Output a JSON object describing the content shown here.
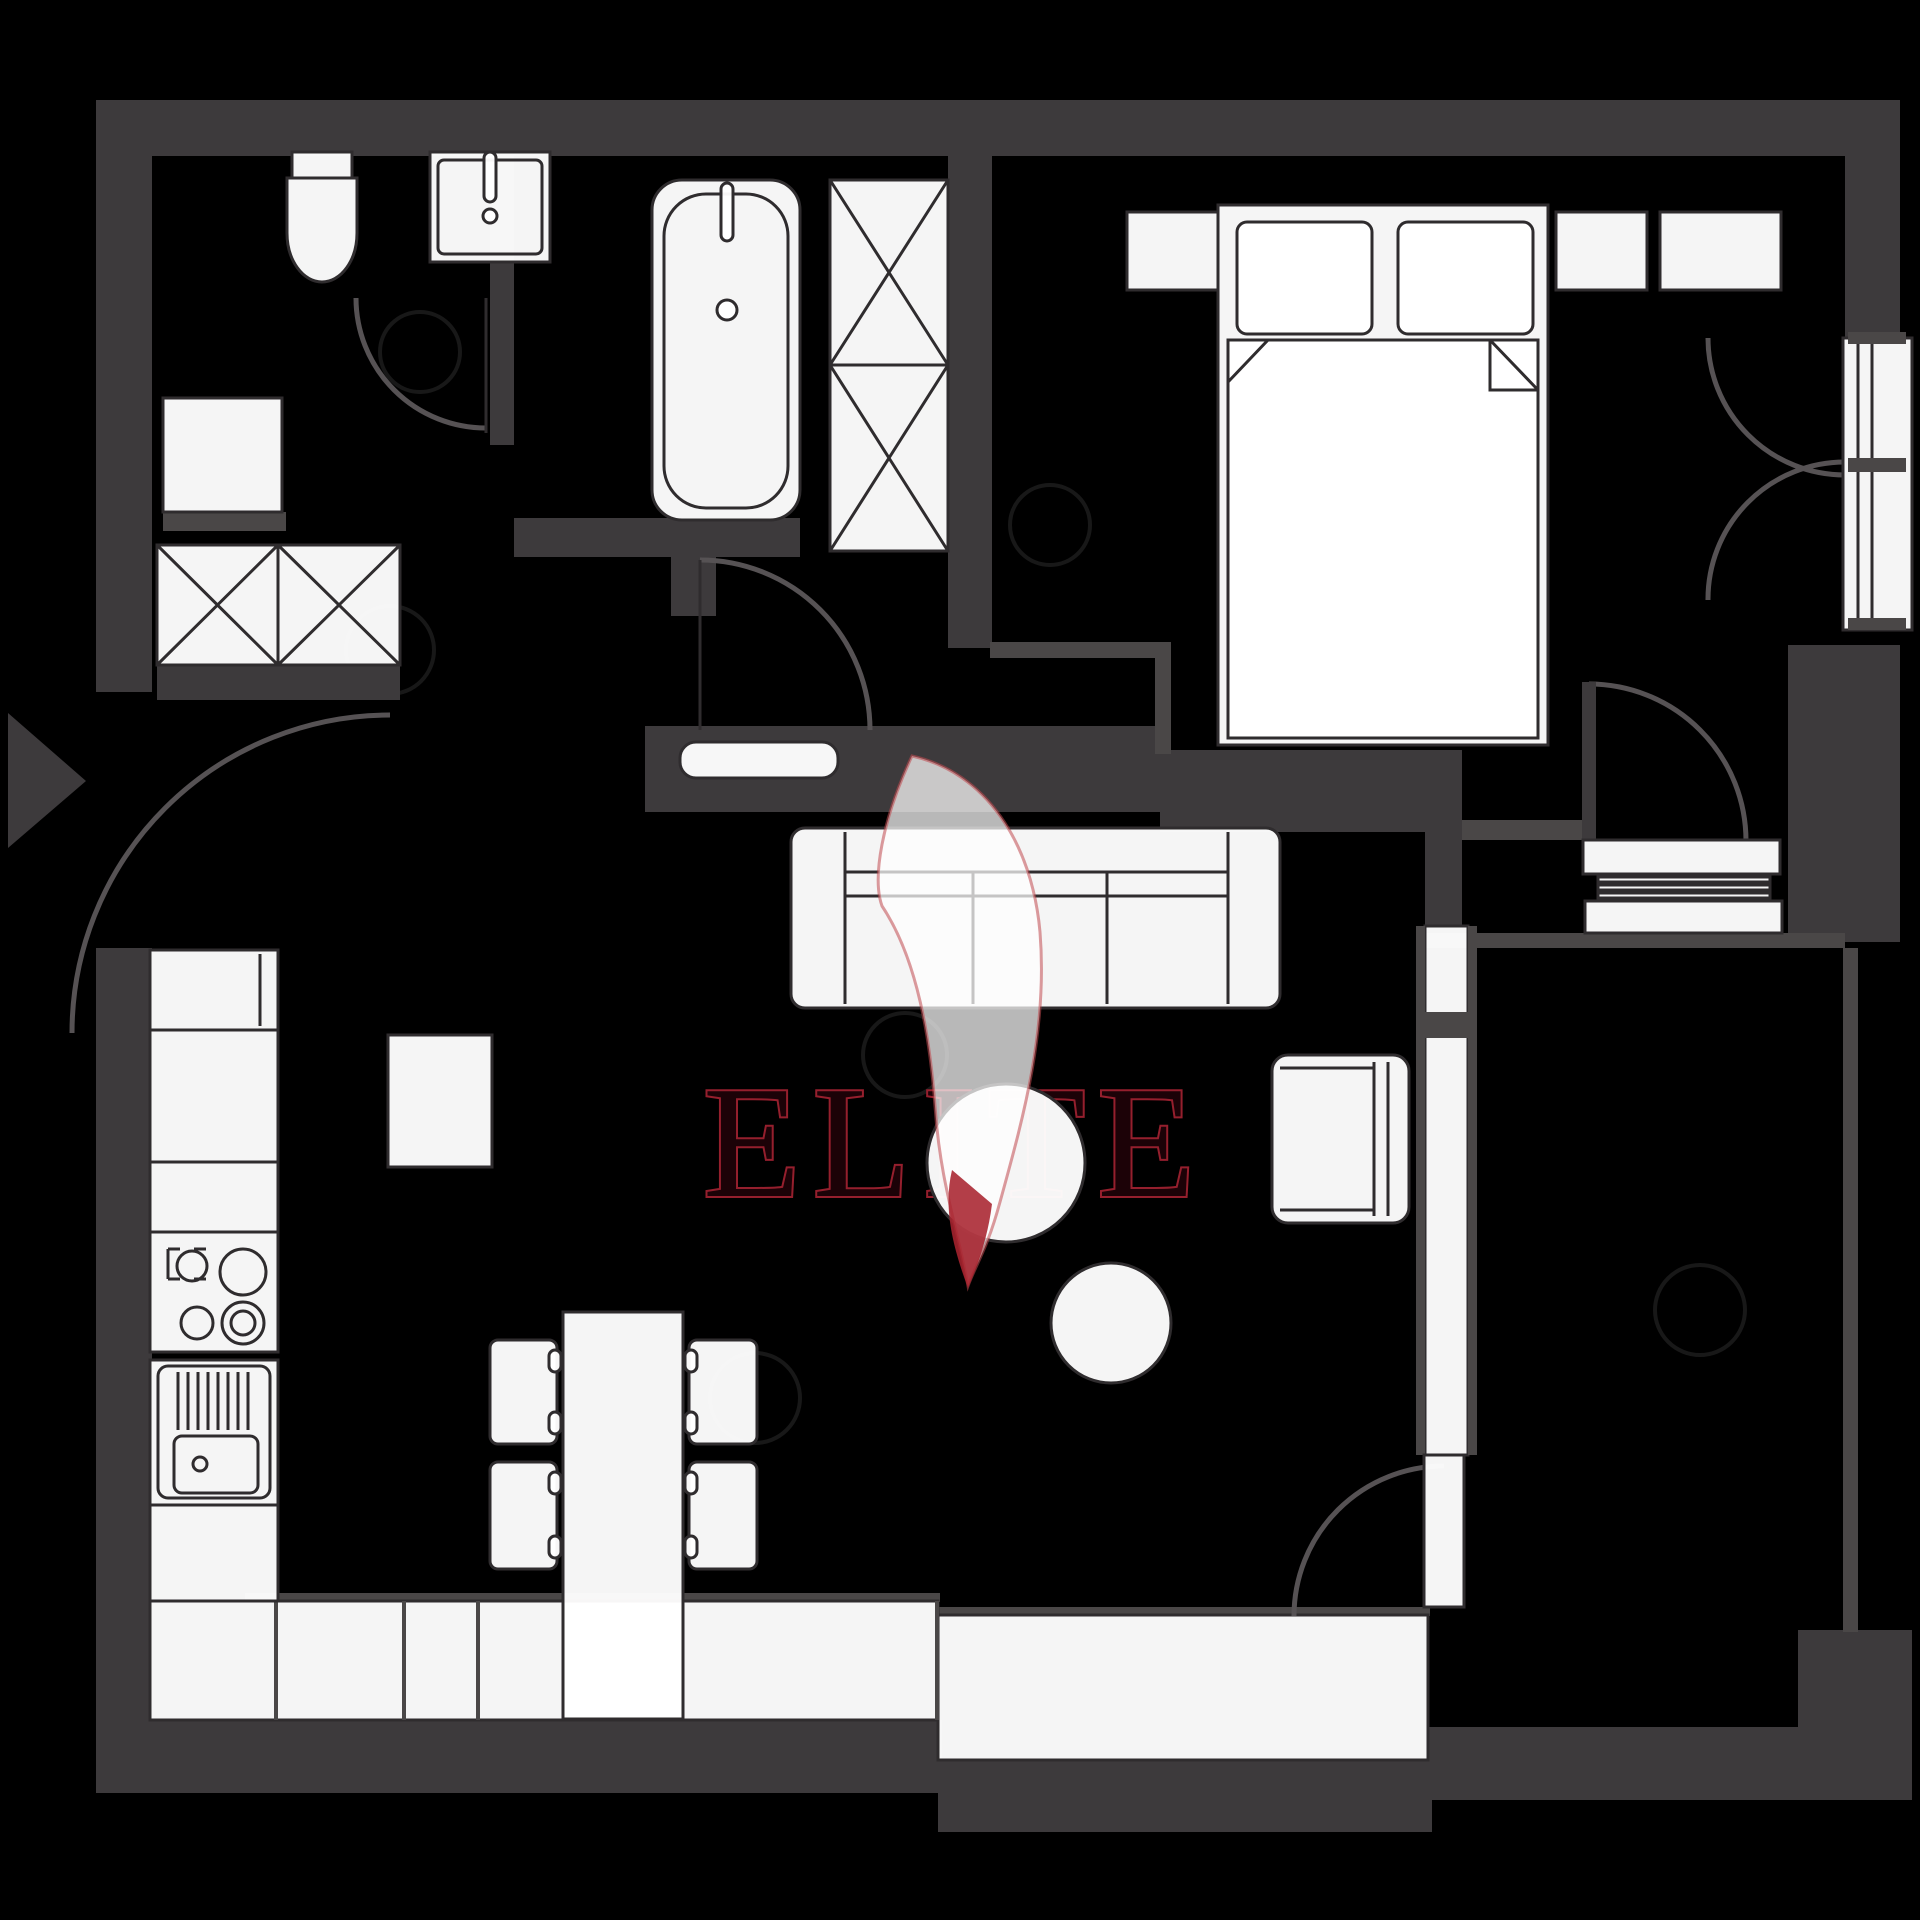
{
  "watermark": {
    "brand": "ELITE"
  },
  "colors": {
    "bg": "#000000",
    "wall": "#3d3a3c",
    "wall-line": "#4a4747",
    "outline": "#2f2c2e",
    "fixture": "#ffffff",
    "arc": "#565254",
    "logo-fill": "#1e0308",
    "logo-rim": "#9e2130",
    "flame-edge": "#c0494f",
    "flame-tip": "#a8232f"
  },
  "plan": {
    "type": "apartment-floor-plan",
    "rooms": [
      "wc",
      "bathroom",
      "bedroom",
      "hallway",
      "kitchen-living-room",
      "second-room",
      "balcony-strip"
    ],
    "fixtures": [
      "toilet",
      "wc-sink",
      "shower-unit",
      "washing-machine-x2",
      "bathtub",
      "bathroom-cabinet",
      "double-bed",
      "pillows-x2",
      "nightstand-x2",
      "bedroom-dresser",
      "bedroom-french-window",
      "sofa-3-seat",
      "armchair",
      "coffee-table-round-large",
      "coffee-table-round-small",
      "kitchen-counter-run",
      "stove-4-burners",
      "kitchen-sink",
      "fridge",
      "dining-table",
      "dining-chairs-x4",
      "hall-sideboard",
      "sliding-partition",
      "entrance-arrow",
      "door-swing-arcs"
    ]
  }
}
